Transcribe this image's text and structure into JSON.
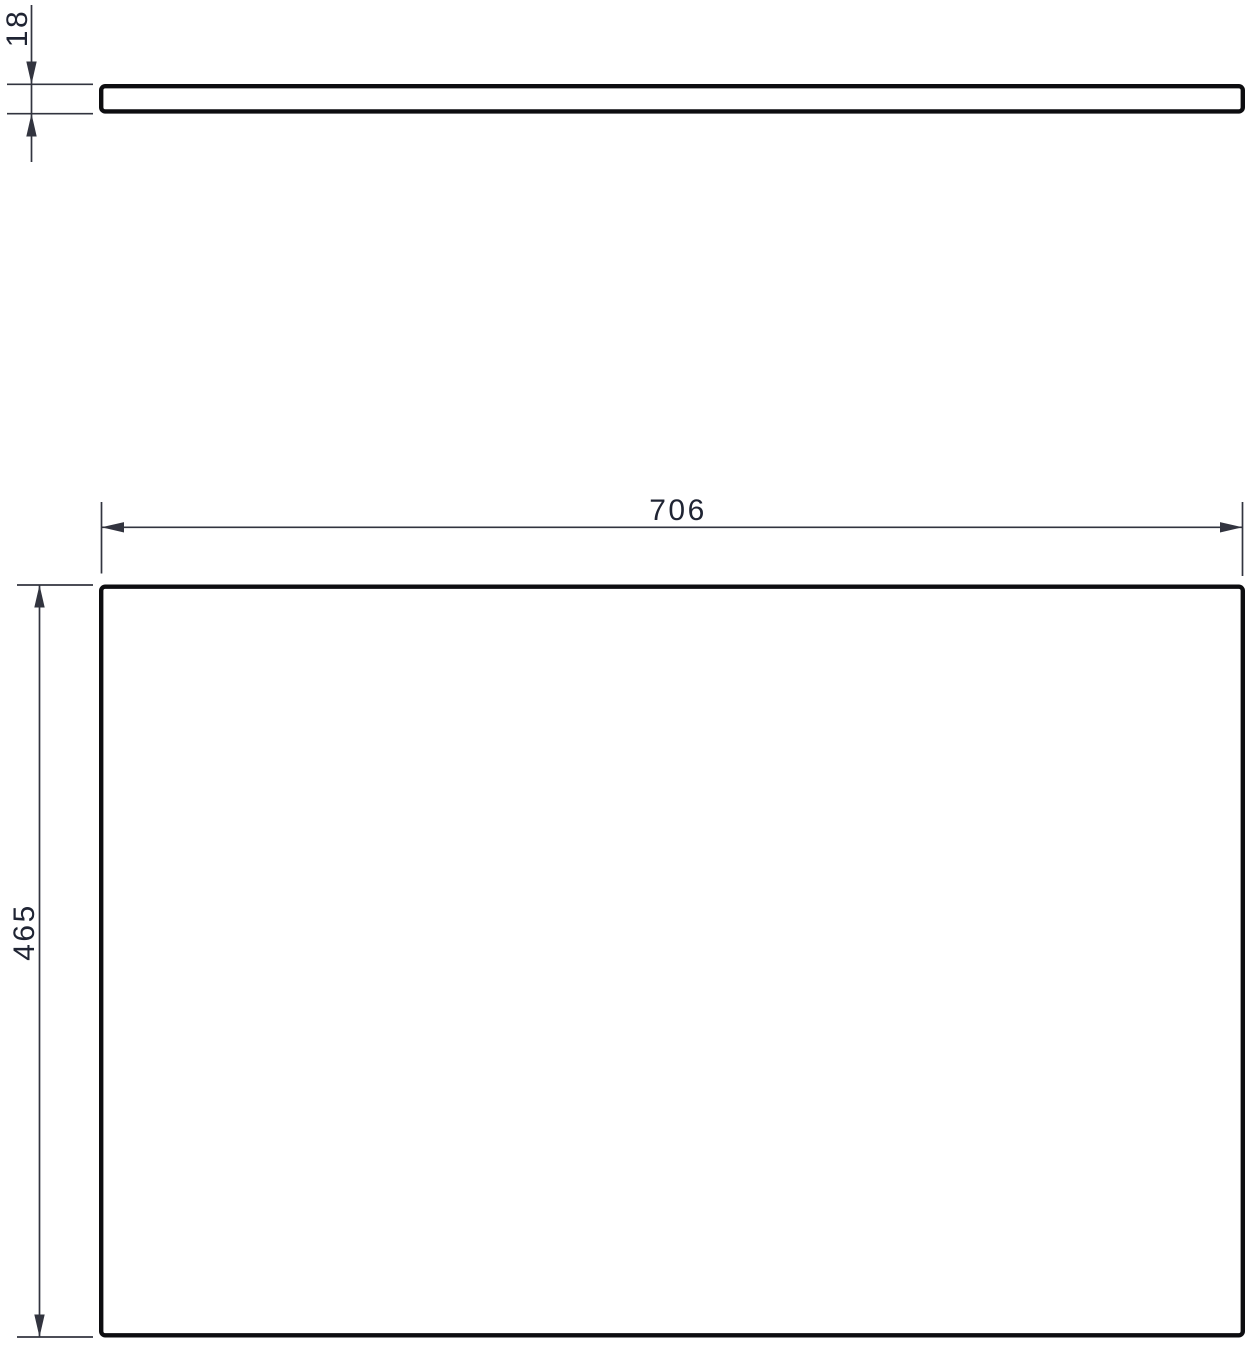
{
  "colors": {
    "background": "#ffffff",
    "outline": "#0d0d10",
    "dimension": "#32343f",
    "text": "#1f2433"
  },
  "dimensions": {
    "thickness": {
      "value": "18"
    },
    "width": {
      "value": "706"
    },
    "height": {
      "value": "465"
    }
  }
}
